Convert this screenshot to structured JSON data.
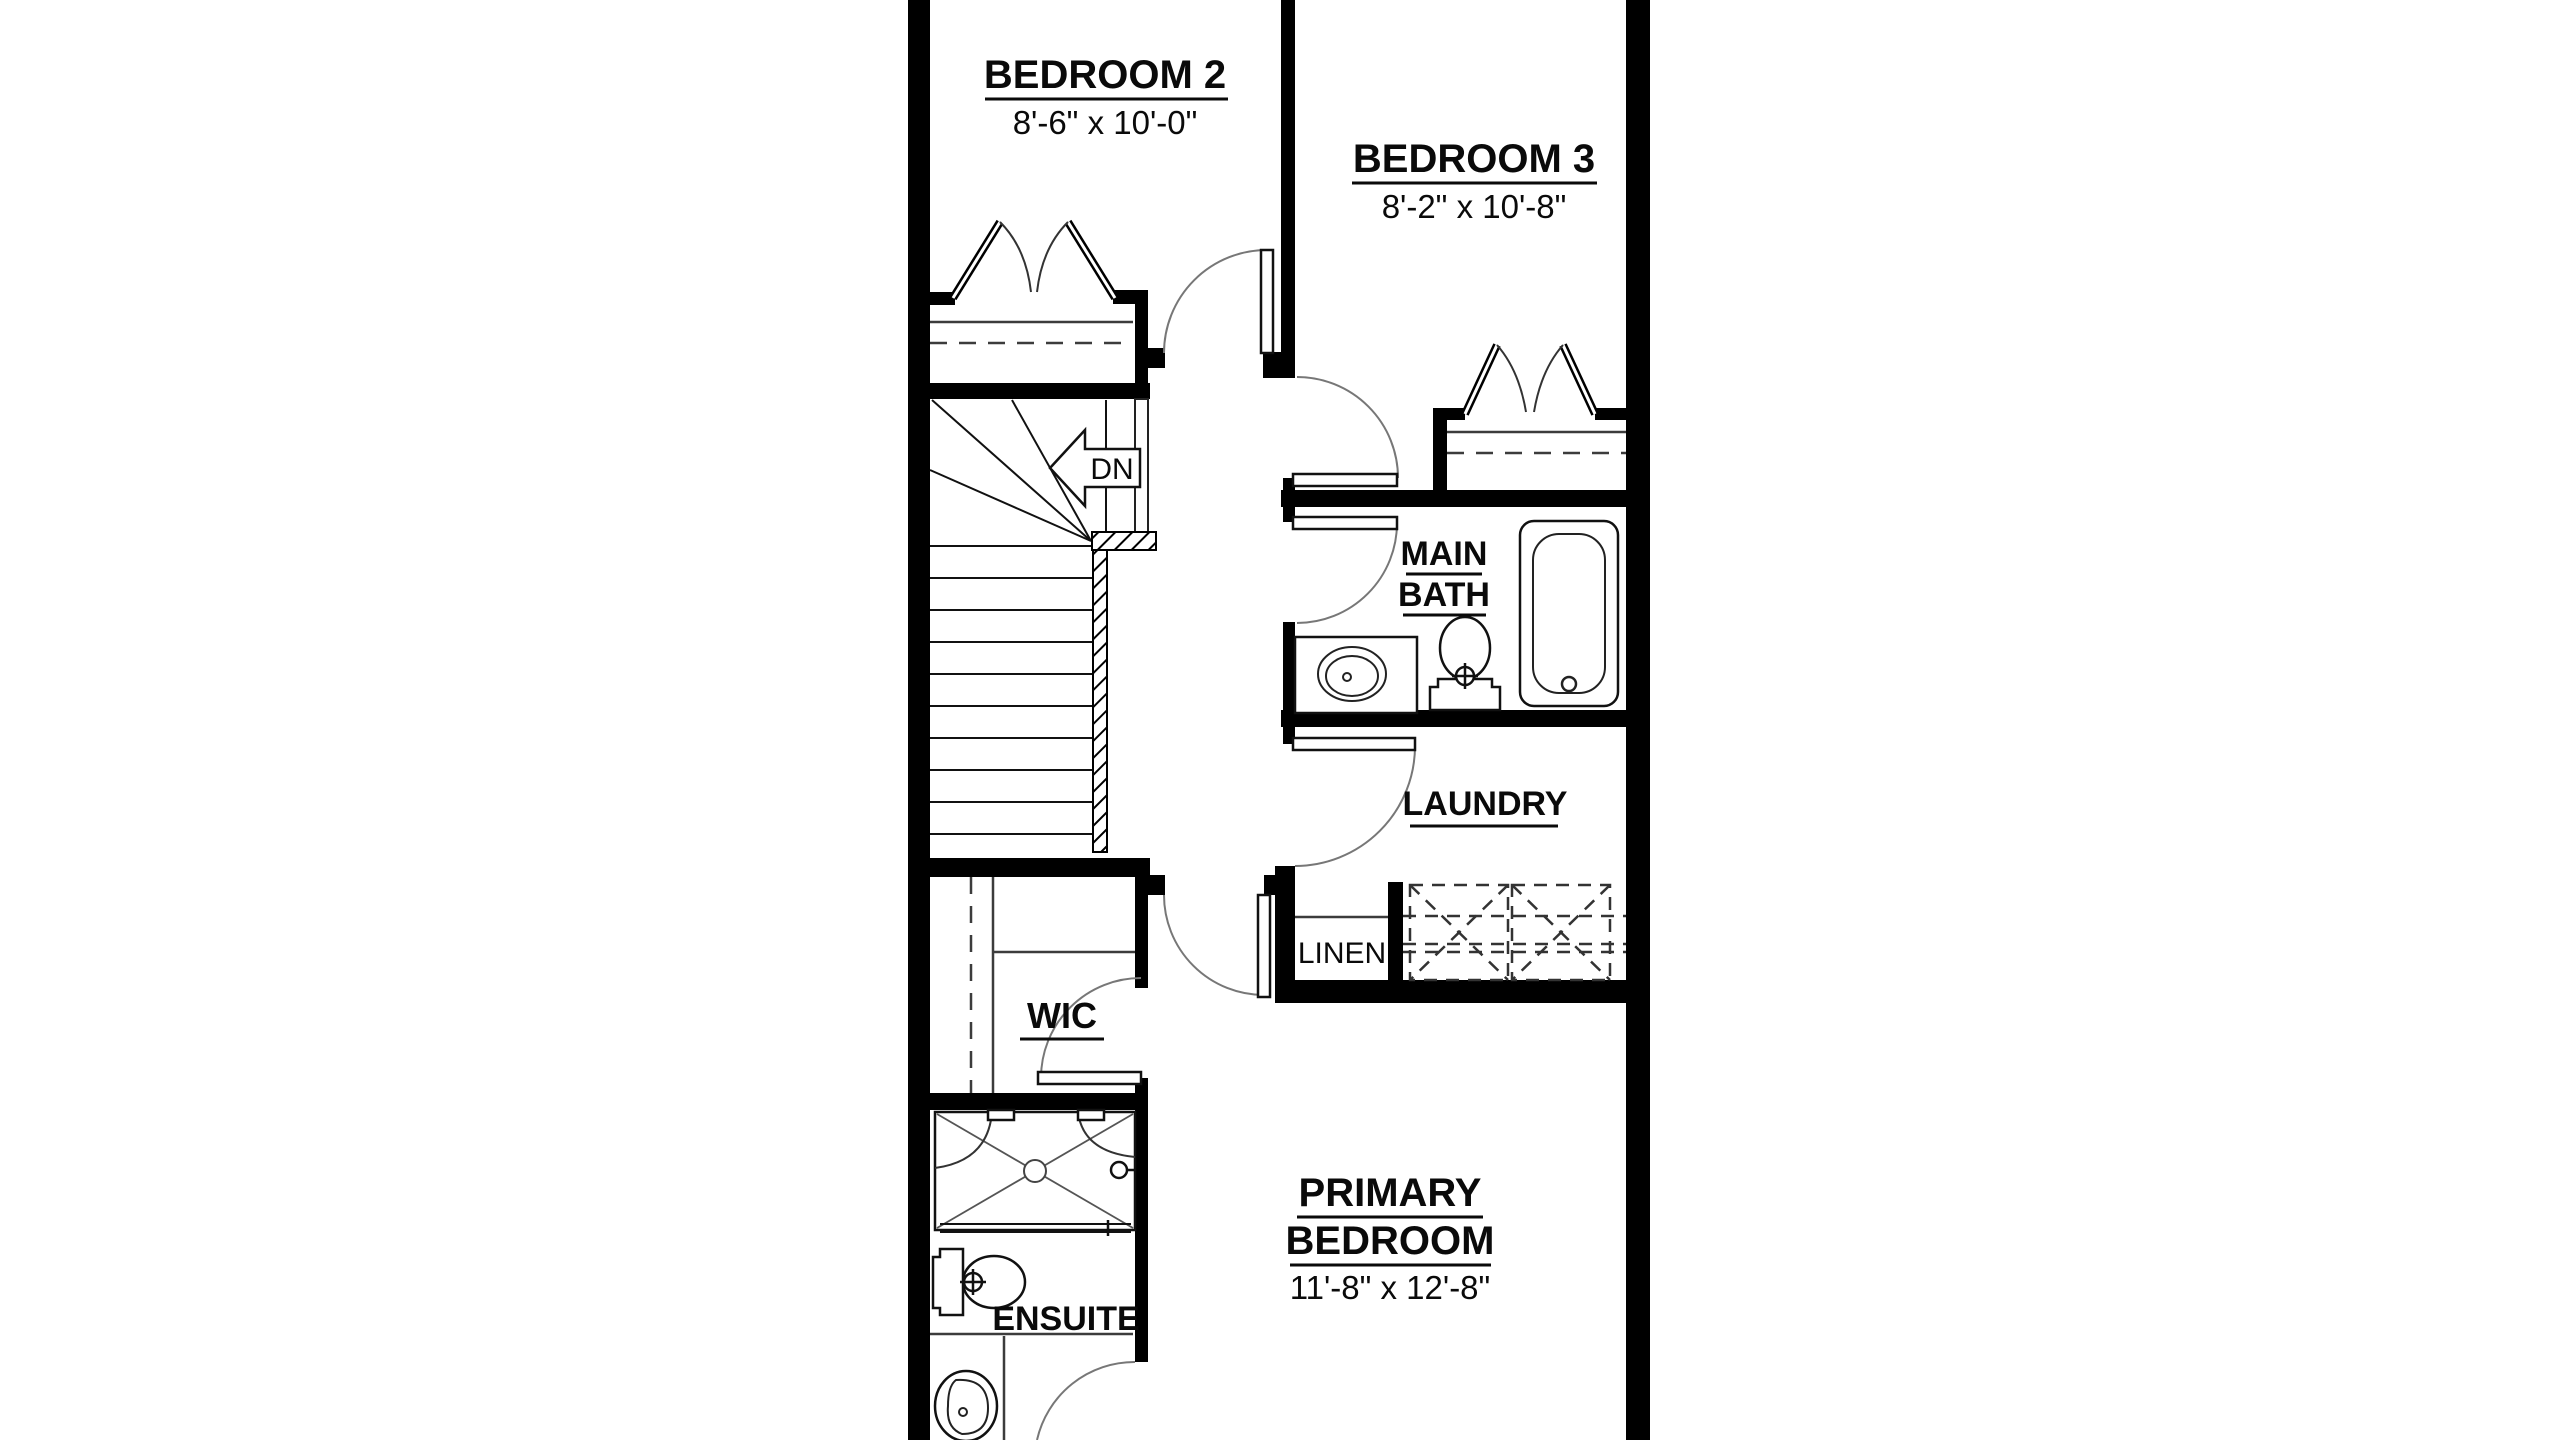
{
  "rooms": {
    "bedroom2": {
      "name": "BEDROOM 2",
      "dims": "8'-6\" x 10'-0\""
    },
    "bedroom3": {
      "name": "BEDROOM 3",
      "dims": "8'-2\" x 10'-8\""
    },
    "main_bath": {
      "line1": "MAIN",
      "line2": "BATH"
    },
    "laundry": {
      "name": "LAUNDRY"
    },
    "linen": {
      "name": "LINEN"
    },
    "wic": {
      "name": "WIC"
    },
    "ensuite": {
      "name": "ENSUITE"
    },
    "primary_bedroom": {
      "line1": "PRIMARY",
      "line2": "BEDROOM",
      "dims": "11'-8\" x 12'-8\""
    }
  },
  "stairs": {
    "label": "DN"
  },
  "colors": {
    "wall": "#000000",
    "line": "#3c3c3c",
    "background": "#ffffff"
  }
}
